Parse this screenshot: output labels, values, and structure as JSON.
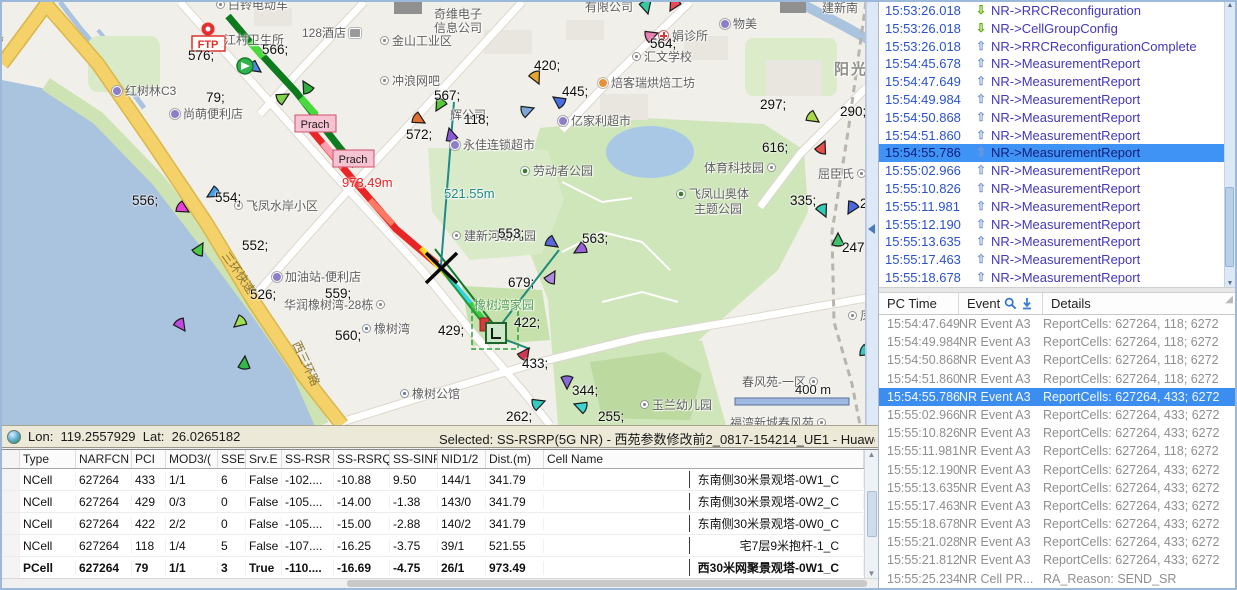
{
  "map": {
    "markers": {
      "ftp": "FTP",
      "prach1": "Prach",
      "prach2": "Prach"
    },
    "labels": [
      {
        "t": "白铃电动车",
        "x": 214,
        "y": -6,
        "c": "poi ico-o"
      },
      {
        "t": "江村卫生所",
        "x": 222,
        "y": 29,
        "c": "poi"
      },
      {
        "t": "128酒店",
        "x": 300,
        "y": 22,
        "c": "poi ico-bed ico-after"
      },
      {
        "t": "金山工业区",
        "x": 378,
        "y": 30,
        "c": "poi ico-o"
      },
      {
        "t": "奇维电子",
        "x": 432,
        "y": 3,
        "c": "poi"
      },
      {
        "t": "信息公司",
        "x": 432,
        "y": 17,
        "c": "poi"
      },
      {
        "t": "有限公司",
        "x": 583,
        "y": -4,
        "c": "poi"
      },
      {
        "t": "物美",
        "x": 718,
        "y": 13,
        "c": "poi ico-cam"
      },
      {
        "t": "娟诊所",
        "x": 656,
        "y": 25,
        "c": "poi ico-plus"
      },
      {
        "t": "汇文学校",
        "x": 630,
        "y": 46,
        "c": "poi ico-o"
      },
      {
        "t": "焙客瑞烘焙工坊",
        "x": 596,
        "y": 72,
        "c": "poi ico-dot"
      },
      {
        "t": "冲浪网吧",
        "x": 378,
        "y": 70,
        "c": "poi ico-o"
      },
      {
        "t": "辉公司",
        "x": 448,
        "y": 104,
        "c": "poi"
      },
      {
        "t": "亿家利超市",
        "x": 556,
        "y": 110,
        "c": "poi ico-cam"
      },
      {
        "t": "永佳连锁超市",
        "x": 448,
        "y": 134,
        "c": "poi ico-cam"
      },
      {
        "t": "劳动者公园",
        "x": 518,
        "y": 160,
        "c": "poi ico-tree"
      },
      {
        "t": "体育科技园",
        "x": 702,
        "y": 157,
        "c": "poi ico-o ico-after"
      },
      {
        "t": "飞凤山奥体",
        "x": 674,
        "y": 183,
        "c": "poi ico-tree"
      },
      {
        "t": "主题公园",
        "x": 692,
        "y": 198,
        "c": "poi"
      },
      {
        "t": "屈臣氏",
        "x": 816,
        "y": 163,
        "c": "poi ico-o ico-after"
      },
      {
        "t": "飞凤水岸小区",
        "x": 232,
        "y": 195,
        "c": "poi ico-o"
      },
      {
        "t": "红树林C3",
        "x": 110,
        "y": 80,
        "c": "poi ico-cam"
      },
      {
        "t": "尚萌便利店",
        "x": 168,
        "y": 103,
        "c": "poi ico-cam"
      },
      {
        "t": "加油站-便利店",
        "x": 270,
        "y": 266,
        "c": "poi ico-cam"
      },
      {
        "t": "华润橡树湾-28栋",
        "x": 282,
        "y": 294,
        "c": "poi ico-o ico-after"
      },
      {
        "t": "橡树湾",
        "x": 360,
        "y": 318,
        "c": "poi ico-bld"
      },
      {
        "t": "橡树公馆",
        "x": 398,
        "y": 383,
        "c": "poi ico-bld"
      },
      {
        "t": "玉兰幼儿园",
        "x": 638,
        "y": 394,
        "c": "poi ico-o"
      },
      {
        "t": "建新河幼儿园",
        "x": 450,
        "y": 225,
        "c": "poi ico-o"
      },
      {
        "t": "橡树湾家园",
        "x": 472,
        "y": 294,
        "c": "park-name"
      },
      {
        "t": "春风苑-一区",
        "x": 740,
        "y": 371,
        "c": "poi ico-o ico-after"
      },
      {
        "t": "福湾新城春风苑",
        "x": 728,
        "y": 412,
        "c": "poi ico-o ico-after"
      },
      {
        "t": "阳光城",
        "x": 832,
        "y": 56,
        "c": "city"
      },
      {
        "t": "建新南",
        "x": 820,
        "y": -3,
        "c": "poi"
      },
      {
        "t": "凤山",
        "x": 846,
        "y": 305,
        "c": "poi ico-o"
      },
      {
        "t": "西三环路",
        "x": 302,
        "y": 336,
        "c": "roadlbl rot65"
      },
      {
        "t": "三环快速",
        "x": 230,
        "y": 246,
        "c": "roadlbl rot55"
      },
      {
        "t": "坂快速",
        "x": -4,
        "y": 4,
        "c": "roadlbl rot75"
      },
      {
        "t": "576;",
        "x": 186,
        "y": 46,
        "c": "pci"
      },
      {
        "t": "566;",
        "x": 260,
        "y": 40,
        "c": "pci"
      },
      {
        "t": "79;",
        "x": 204,
        "y": 88,
        "c": "pci"
      },
      {
        "t": "567;",
        "x": 432,
        "y": 86,
        "c": "pci"
      },
      {
        "t": "118;",
        "x": 462,
        "y": 110,
        "c": "pci"
      },
      {
        "t": "572;",
        "x": 404,
        "y": 125,
        "c": "pci"
      },
      {
        "t": "420;",
        "x": 532,
        "y": 56,
        "c": "pci"
      },
      {
        "t": "445;",
        "x": 560,
        "y": 82,
        "c": "pci"
      },
      {
        "t": "564;",
        "x": 648,
        "y": 34,
        "c": "pci"
      },
      {
        "t": "297;",
        "x": 758,
        "y": 95,
        "c": "pci"
      },
      {
        "t": "290;",
        "x": 838,
        "y": 102,
        "c": "pci"
      },
      {
        "t": "616;",
        "x": 760,
        "y": 138,
        "c": "pci"
      },
      {
        "t": "335;",
        "x": 788,
        "y": 191,
        "c": "pci"
      },
      {
        "t": "247;",
        "x": 840,
        "y": 238,
        "c": "pci"
      },
      {
        "t": "2",
        "x": 858,
        "y": 194,
        "c": "pci"
      },
      {
        "t": "556;",
        "x": 130,
        "y": 191,
        "c": "pci"
      },
      {
        "t": "554;",
        "x": 213,
        "y": 188,
        "c": "pci"
      },
      {
        "t": "552;",
        "x": 240,
        "y": 236,
        "c": "pci"
      },
      {
        "t": "526;",
        "x": 248,
        "y": 285,
        "c": "pci"
      },
      {
        "t": "559;",
        "x": 323,
        "y": 284,
        "c": "pci"
      },
      {
        "t": "560;",
        "x": 333,
        "y": 326,
        "c": "pci"
      },
      {
        "t": "429;",
        "x": 436,
        "y": 321,
        "c": "pci"
      },
      {
        "t": "422;",
        "x": 512,
        "y": 313,
        "c": "pci"
      },
      {
        "t": "433;",
        "x": 520,
        "y": 354,
        "c": "pci"
      },
      {
        "t": "344;",
        "x": 570,
        "y": 381,
        "c": "pci"
      },
      {
        "t": "262;",
        "x": 504,
        "y": 407,
        "c": "pci"
      },
      {
        "t": "255;",
        "x": 596,
        "y": 407,
        "c": "pci"
      },
      {
        "t": "679;",
        "x": 506,
        "y": 273,
        "c": "pci"
      },
      {
        "t": "563;",
        "x": 580,
        "y": 229,
        "c": "pci"
      },
      {
        "t": "553;",
        "x": 496,
        "y": 224,
        "c": "pci"
      },
      {
        "t": "973.49m",
        "x": 340,
        "y": 173,
        "c": "dist-red"
      },
      {
        "t": "521.55m",
        "x": 442,
        "y": 184,
        "c": "dist-teal"
      },
      {
        "t": "400 m",
        "x": 793,
        "y": 380,
        "c": "scale-txt"
      }
    ],
    "routes": [
      {
        "name": "route-trace-green",
        "color": "#0e7a1e",
        "w": 7,
        "pts": [
          [
            226,
            14
          ],
          [
            248,
            40
          ],
          [
            270,
            64
          ],
          [
            294,
            90
          ],
          [
            316,
            118
          ],
          [
            338,
            146
          ],
          [
            353,
            164
          ]
        ]
      },
      {
        "name": "route-trace-green-light",
        "color": "#49d93c",
        "w": 7,
        "pts": [
          [
            248,
            40
          ],
          [
            261,
            55
          ]
        ]
      },
      {
        "name": "route-trace-green-light",
        "color": "#49d93c",
        "w": 7,
        "pts": [
          [
            299,
            96
          ],
          [
            314,
            113
          ]
        ]
      },
      {
        "name": "route-trace-red",
        "color": "#e92525",
        "w": 7,
        "pts": [
          [
            305,
            123
          ],
          [
            348,
            174
          ],
          [
            394,
            227
          ],
          [
            435,
            262
          ]
        ]
      },
      {
        "name": "route-trace-pink",
        "color": "#ffa0b0",
        "w": 7,
        "pts": [
          [
            321,
            141
          ],
          [
            341,
            165
          ]
        ]
      },
      {
        "name": "route-trace-salmon",
        "color": "#ff7a66",
        "w": 6,
        "pts": [
          [
            368,
            198
          ],
          [
            391,
            222
          ]
        ]
      },
      {
        "name": "event-line-red",
        "color": "#e93333",
        "w": 2,
        "pts": [
          [
            435,
            262
          ],
          [
            489,
            331
          ]
        ]
      },
      {
        "name": "route-trace-yellow",
        "color": "#ffd822",
        "w": 5,
        "pts": [
          [
            419,
            246
          ],
          [
            447,
            276
          ]
        ]
      },
      {
        "name": "route-trace-cyan",
        "color": "#2fd4e8",
        "w": 5,
        "pts": [
          [
            447,
            276
          ],
          [
            468,
            301
          ]
        ]
      },
      {
        "name": "route-trace-green2",
        "color": "#3fc943",
        "w": 5,
        "pts": [
          [
            468,
            301
          ],
          [
            497,
            336
          ]
        ]
      },
      {
        "name": "trace-thin-green",
        "color": "#1e9a3a",
        "w": 2,
        "pts": [
          [
            427,
            252
          ],
          [
            497,
            342
          ]
        ]
      },
      {
        "name": "trace-thin-green",
        "color": "#0e7a2e",
        "w": 2,
        "pts": [
          [
            433,
            247
          ],
          [
            503,
            337
          ]
        ]
      },
      {
        "name": "measure-line-teal",
        "color": "#1f8a8a",
        "w": 2,
        "pts": [
          [
            452,
            100
          ],
          [
            439,
            263
          ]
        ]
      },
      {
        "name": "measure-line-teal",
        "color": "#1f8a7a",
        "w": 2,
        "pts": [
          [
            491,
            333
          ],
          [
            557,
            248
          ]
        ]
      },
      {
        "name": "measure-line-teal",
        "color": "#1f8a7a",
        "w": 2,
        "pts": [
          [
            491,
            333
          ],
          [
            528,
            347
          ]
        ]
      }
    ],
    "sectors": [
      [
        259,
        70,
        215,
        "#4a8ae8"
      ],
      [
        287,
        92,
        150,
        "#7fd24a"
      ],
      [
        301,
        79,
        60,
        "#2fae3f"
      ],
      [
        537,
        82,
        245,
        "#e2a62c"
      ],
      [
        551,
        95,
        35,
        "#4a6fe0"
      ],
      [
        532,
        106,
        160,
        "#7aa7d8"
      ],
      [
        434,
        109,
        300,
        "#57c936"
      ],
      [
        423,
        121,
        210,
        "#e0702f"
      ],
      [
        447,
        126,
        75,
        "#8b58d8"
      ],
      [
        646,
        12,
        255,
        "#35c9a0"
      ],
      [
        668,
        9,
        300,
        "#e84a5a"
      ],
      [
        656,
        31,
        160,
        "#ec7fb2"
      ],
      [
        817,
        120,
        215,
        "#a8d84a"
      ],
      [
        871,
        126,
        320,
        "#3fc04a"
      ],
      [
        823,
        139,
        115,
        "#e8504a"
      ],
      [
        824,
        215,
        245,
        "#35c9b8"
      ],
      [
        846,
        212,
        300,
        "#4a68e0"
      ],
      [
        836,
        231,
        90,
        "#3fc06a"
      ],
      [
        187,
        210,
        210,
        "#e83fd8"
      ],
      [
        205,
        195,
        330,
        "#4aa0e8"
      ],
      [
        201,
        241,
        120,
        "#4ac848"
      ],
      [
        183,
        329,
        235,
        "#c04ae0"
      ],
      [
        232,
        325,
        320,
        "#9fdd52"
      ],
      [
        243,
        354,
        95,
        "#35b84a"
      ],
      [
        556,
        245,
        215,
        "#5a68d8"
      ],
      [
        572,
        251,
        330,
        "#9a62d8"
      ],
      [
        553,
        269,
        120,
        "#b08ae0"
      ],
      [
        565,
        387,
        270,
        "#8a68d8"
      ],
      [
        543,
        399,
        160,
        "#35c9c0"
      ],
      [
        572,
        402,
        20,
        "#3fd0d0"
      ],
      [
        527,
        346,
        125,
        "#cc3a55"
      ],
      [
        871,
        352,
        200,
        "#38c9c0"
      ]
    ]
  },
  "status": {
    "lon_label": "Lon:",
    "lon": "119.2557929",
    "lat_label": "Lat:",
    "lat": "26.0265182",
    "selected": "Selected: SS-RSRP(5G NR) - 西苑参数修改前2_0817-154214_UE1 - Huawei M"
  },
  "cell_table": {
    "columns": [
      "",
      "Type",
      "NARFCN",
      "PCI",
      "MOD3/(",
      "SSE",
      "Srv.E",
      "SS-RSR",
      "SS-RSRQ",
      "SS-SINR",
      "NID1/2",
      "Dist.(m)",
      "Cell Name"
    ],
    "rows": [
      {
        "cells": [
          "NCell",
          "627264",
          "433",
          "1/1",
          "6",
          "False",
          "-102....",
          "-10.88",
          "9.50",
          "144/1",
          "341.79",
          "东南侧30米景观塔-0W1_C"
        ]
      },
      {
        "cells": [
          "NCell",
          "627264",
          "429",
          "0/3",
          "0",
          "False",
          "-105....",
          "-14.00",
          "-1.38",
          "143/0",
          "341.79",
          "东南侧30米景观塔-0W2_C"
        ]
      },
      {
        "cells": [
          "NCell",
          "627264",
          "422",
          "2/2",
          "0",
          "False",
          "-105....",
          "-15.00",
          "-2.88",
          "140/2",
          "341.79",
          "东南侧30米景观塔-0W0_C"
        ]
      },
      {
        "cells": [
          "NCell",
          "627264",
          "118",
          "1/4",
          "5",
          "False",
          "-107....",
          "-16.25",
          "-3.75",
          "39/1",
          "521.55",
          "宅7层9米抱杆-1_C"
        ]
      },
      {
        "cells": [
          "PCell",
          "627264",
          "79",
          "1/1",
          "3",
          "True",
          "-110....",
          "-16.69",
          "-4.75",
          "26/1",
          "973.49",
          "西30米网聚景观塔-0W1_C"
        ],
        "c": "pcell-row"
      }
    ]
  },
  "signaling": {
    "rows": [
      {
        "time": "15:53:26.018",
        "msg": "NR->RRCReconfiguration",
        "c": "dl"
      },
      {
        "time": "15:53:26.018",
        "msg": "NR->CellGroupConfig",
        "c": "dl"
      },
      {
        "time": "15:53:26.018",
        "msg": "NR->RRCReconfigurationComplete",
        "c": "ul"
      },
      {
        "time": "15:54:45.678",
        "msg": "NR->MeasurementReport",
        "c": "ul"
      },
      {
        "time": "15:54:47.649",
        "msg": "NR->MeasurementReport",
        "c": "ul"
      },
      {
        "time": "15:54:49.984",
        "msg": "NR->MeasurementReport",
        "c": "ul"
      },
      {
        "time": "15:54:50.868",
        "msg": "NR->MeasurementReport",
        "c": "ul"
      },
      {
        "time": "15:54:51.860",
        "msg": "NR->MeasurementReport",
        "c": "ul"
      },
      {
        "time": "15:54:55.786",
        "msg": "NR->MeasurementReport",
        "c": "ul",
        "sel": true
      },
      {
        "time": "15:55:02.966",
        "msg": "NR->MeasurementReport",
        "c": "ul"
      },
      {
        "time": "15:55:10.826",
        "msg": "NR->MeasurementReport",
        "c": "ul"
      },
      {
        "time": "15:55:11.981",
        "msg": "NR->MeasurementReport",
        "c": "ul"
      },
      {
        "time": "15:55:12.190",
        "msg": "NR->MeasurementReport",
        "c": "ul"
      },
      {
        "time": "15:55:13.635",
        "msg": "NR->MeasurementReport",
        "c": "ul"
      },
      {
        "time": "15:55:17.463",
        "msg": "NR->MeasurementReport",
        "c": "ul"
      },
      {
        "time": "15:55:18.678",
        "msg": "NR->MeasurementReport",
        "c": "ul"
      }
    ]
  },
  "events": {
    "columns": [
      "PC Time",
      "Event",
      "Details"
    ],
    "rows": [
      {
        "time": "15:54:47.649",
        "event": "NR Event A3",
        "details": "ReportCells: 627264, 118; 6272"
      },
      {
        "time": "15:54:49.984",
        "event": "NR Event A3",
        "details": "ReportCells: 627264, 118; 6272"
      },
      {
        "time": "15:54:50.868",
        "event": "NR Event A3",
        "details": "ReportCells: 627264, 118; 6272"
      },
      {
        "time": "15:54:51.860",
        "event": "NR Event A3",
        "details": "ReportCells: 627264, 118; 6272"
      },
      {
        "time": "15:54:55.786",
        "event": "NR Event A3",
        "details": "ReportCells: 627264, 433; 6272",
        "sel": true
      },
      {
        "time": "15:55:02.966",
        "event": "NR Event A3",
        "details": "ReportCells: 627264, 433; 6272"
      },
      {
        "time": "15:55:10.826",
        "event": "NR Event A3",
        "details": "ReportCells: 627264, 433; 6272"
      },
      {
        "time": "15:55:11.981",
        "event": "NR Event A3",
        "details": "ReportCells: 627264, 118; 6272"
      },
      {
        "time": "15:55:12.190",
        "event": "NR Event A3",
        "details": "ReportCells: 627264, 433; 6272"
      },
      {
        "time": "15:55:13.635",
        "event": "NR Event A3",
        "details": "ReportCells: 627264, 433; 6272"
      },
      {
        "time": "15:55:17.463",
        "event": "NR Event A3",
        "details": "ReportCells: 627264, 433; 6272"
      },
      {
        "time": "15:55:18.678",
        "event": "NR Event A3",
        "details": "ReportCells: 627264, 433; 6272"
      },
      {
        "time": "15:55:21.028",
        "event": "NR Event A3",
        "details": "ReportCells: 627264, 433; 6272"
      },
      {
        "time": "15:55:21.812",
        "event": "NR Event A3",
        "details": "ReportCells: 627264, 433; 6272"
      },
      {
        "time": "15:55:25.234",
        "event": "NR Cell PR...",
        "details": "RA_Reason: SEND_SR"
      }
    ]
  }
}
